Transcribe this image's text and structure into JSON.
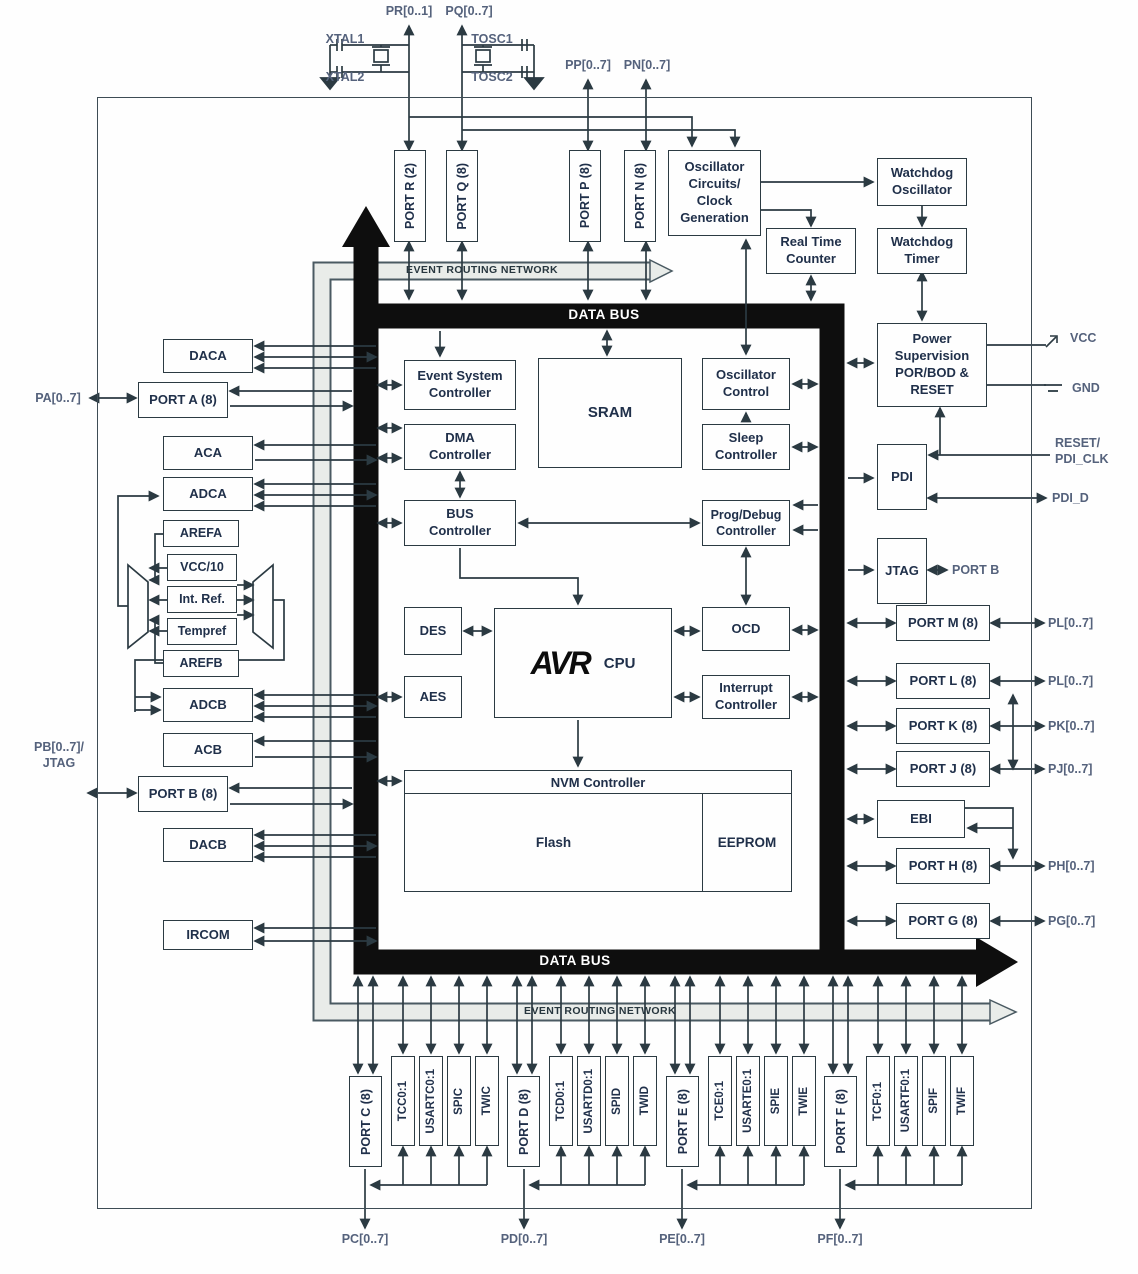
{
  "diagram": {
    "buses": {
      "data_bus": "DATA BUS",
      "event_routing": "EVENT ROUTING NETWORK"
    },
    "top_pins": {
      "pr": "PR[0..1]",
      "pq": "PQ[0..7]",
      "pp": "PP[0..7]",
      "pn": "PN[0..7]",
      "xtal1": "XTAL1",
      "xtal2": "XTAL2",
      "tosc1": "TOSC1",
      "tosc2": "TOSC2"
    },
    "top_blocks": {
      "port_r": "PORT R (2)",
      "port_q": "PORT Q (8)",
      "port_p": "PORT P (8)",
      "port_n": "PORT N (8)",
      "osc": "Oscillator\nCircuits/\nClock\nGeneration",
      "wd_osc": "Watchdog\nOscillator",
      "rtc": "Real Time\nCounter",
      "wd_timer": "Watchdog\nTimer",
      "power": "Power\nSupervision\nPOR/BOD &\nRESET"
    },
    "left_blocks": {
      "daca": "DACA",
      "port_a": "PORT A (8)",
      "aca": "ACA",
      "adca": "ADCA",
      "arefa": "AREFA",
      "vcc10": "VCC/10",
      "int_ref": "Int. Ref.",
      "tempref": "Tempref",
      "arefb": "AREFB",
      "adcb": "ADCB",
      "acb": "ACB",
      "port_b": "PORT B (8)",
      "dacb": "DACB",
      "ircom": "IRCOM"
    },
    "left_pins": {
      "pa": "PA[0..7]",
      "pb": "PB[0..7]/\nJTAG"
    },
    "core_blocks": {
      "event_system": "Event System\nController",
      "dma": "DMA\nController",
      "bus_ctrl": "BUS\nController",
      "sram": "SRAM",
      "osc_ctrl": "Oscillator\nControl",
      "sleep": "Sleep\nController",
      "prog_debug": "Prog/Debug\nController",
      "des": "DES",
      "aes": "AES",
      "avr": "AVR",
      "cpu": "CPU",
      "ocd": "OCD",
      "irq": "Interrupt\nController",
      "nvm": "NVM Controller",
      "flash": "Flash",
      "eeprom": "EEPROM"
    },
    "right_blocks": {
      "pdi": "PDI",
      "jtag": "JTAG",
      "port_m": "PORT M (8)",
      "port_l": "PORT L (8)",
      "port_k": "PORT K (8)",
      "port_j": "PORT J (8)",
      "ebi": "EBI",
      "port_h": "PORT H (8)",
      "port_g": "PORT G (8)"
    },
    "right_pins": {
      "vcc": "VCC",
      "gnd": "GND",
      "reset": "RESET/\nPDI_CLK",
      "pdi_d": "PDI_D",
      "jtag_port": "PORT B",
      "pm": "PL[0..7]",
      "pl": "PL[0..7]",
      "pk": "PK[0..7]",
      "pj": "PJ[0..7]",
      "ph": "PH[0..7]",
      "pg": "PG[0..7]"
    },
    "bottom_groups": [
      {
        "port": "PORT C (8)",
        "peripherals": [
          "TCC0:1",
          "USARTC0:1",
          "SPIC",
          "TWIC"
        ],
        "pin": "PC[0..7]"
      },
      {
        "port": "PORT D (8)",
        "peripherals": [
          "TCD0:1",
          "USARTD0:1",
          "SPID",
          "TWID"
        ],
        "pin": "PD[0..7]"
      },
      {
        "port": "PORT E (8)",
        "peripherals": [
          "TCE0:1",
          "USARTE0:1",
          "SPIE",
          "TWIE"
        ],
        "pin": "PE[0..7]"
      },
      {
        "port": "PORT F (8)",
        "peripherals": [
          "TCF0:1",
          "USARTF0:1",
          "SPIF",
          "TWIF"
        ],
        "pin": "PF[0..7]"
      }
    ],
    "colors": {
      "bus": "#0e0e0e",
      "event_band": "#e9ece9",
      "wire": "#2b3a42",
      "box_border": "#2b3a42",
      "text": "#20304a",
      "pin_text": "#55627c"
    }
  }
}
